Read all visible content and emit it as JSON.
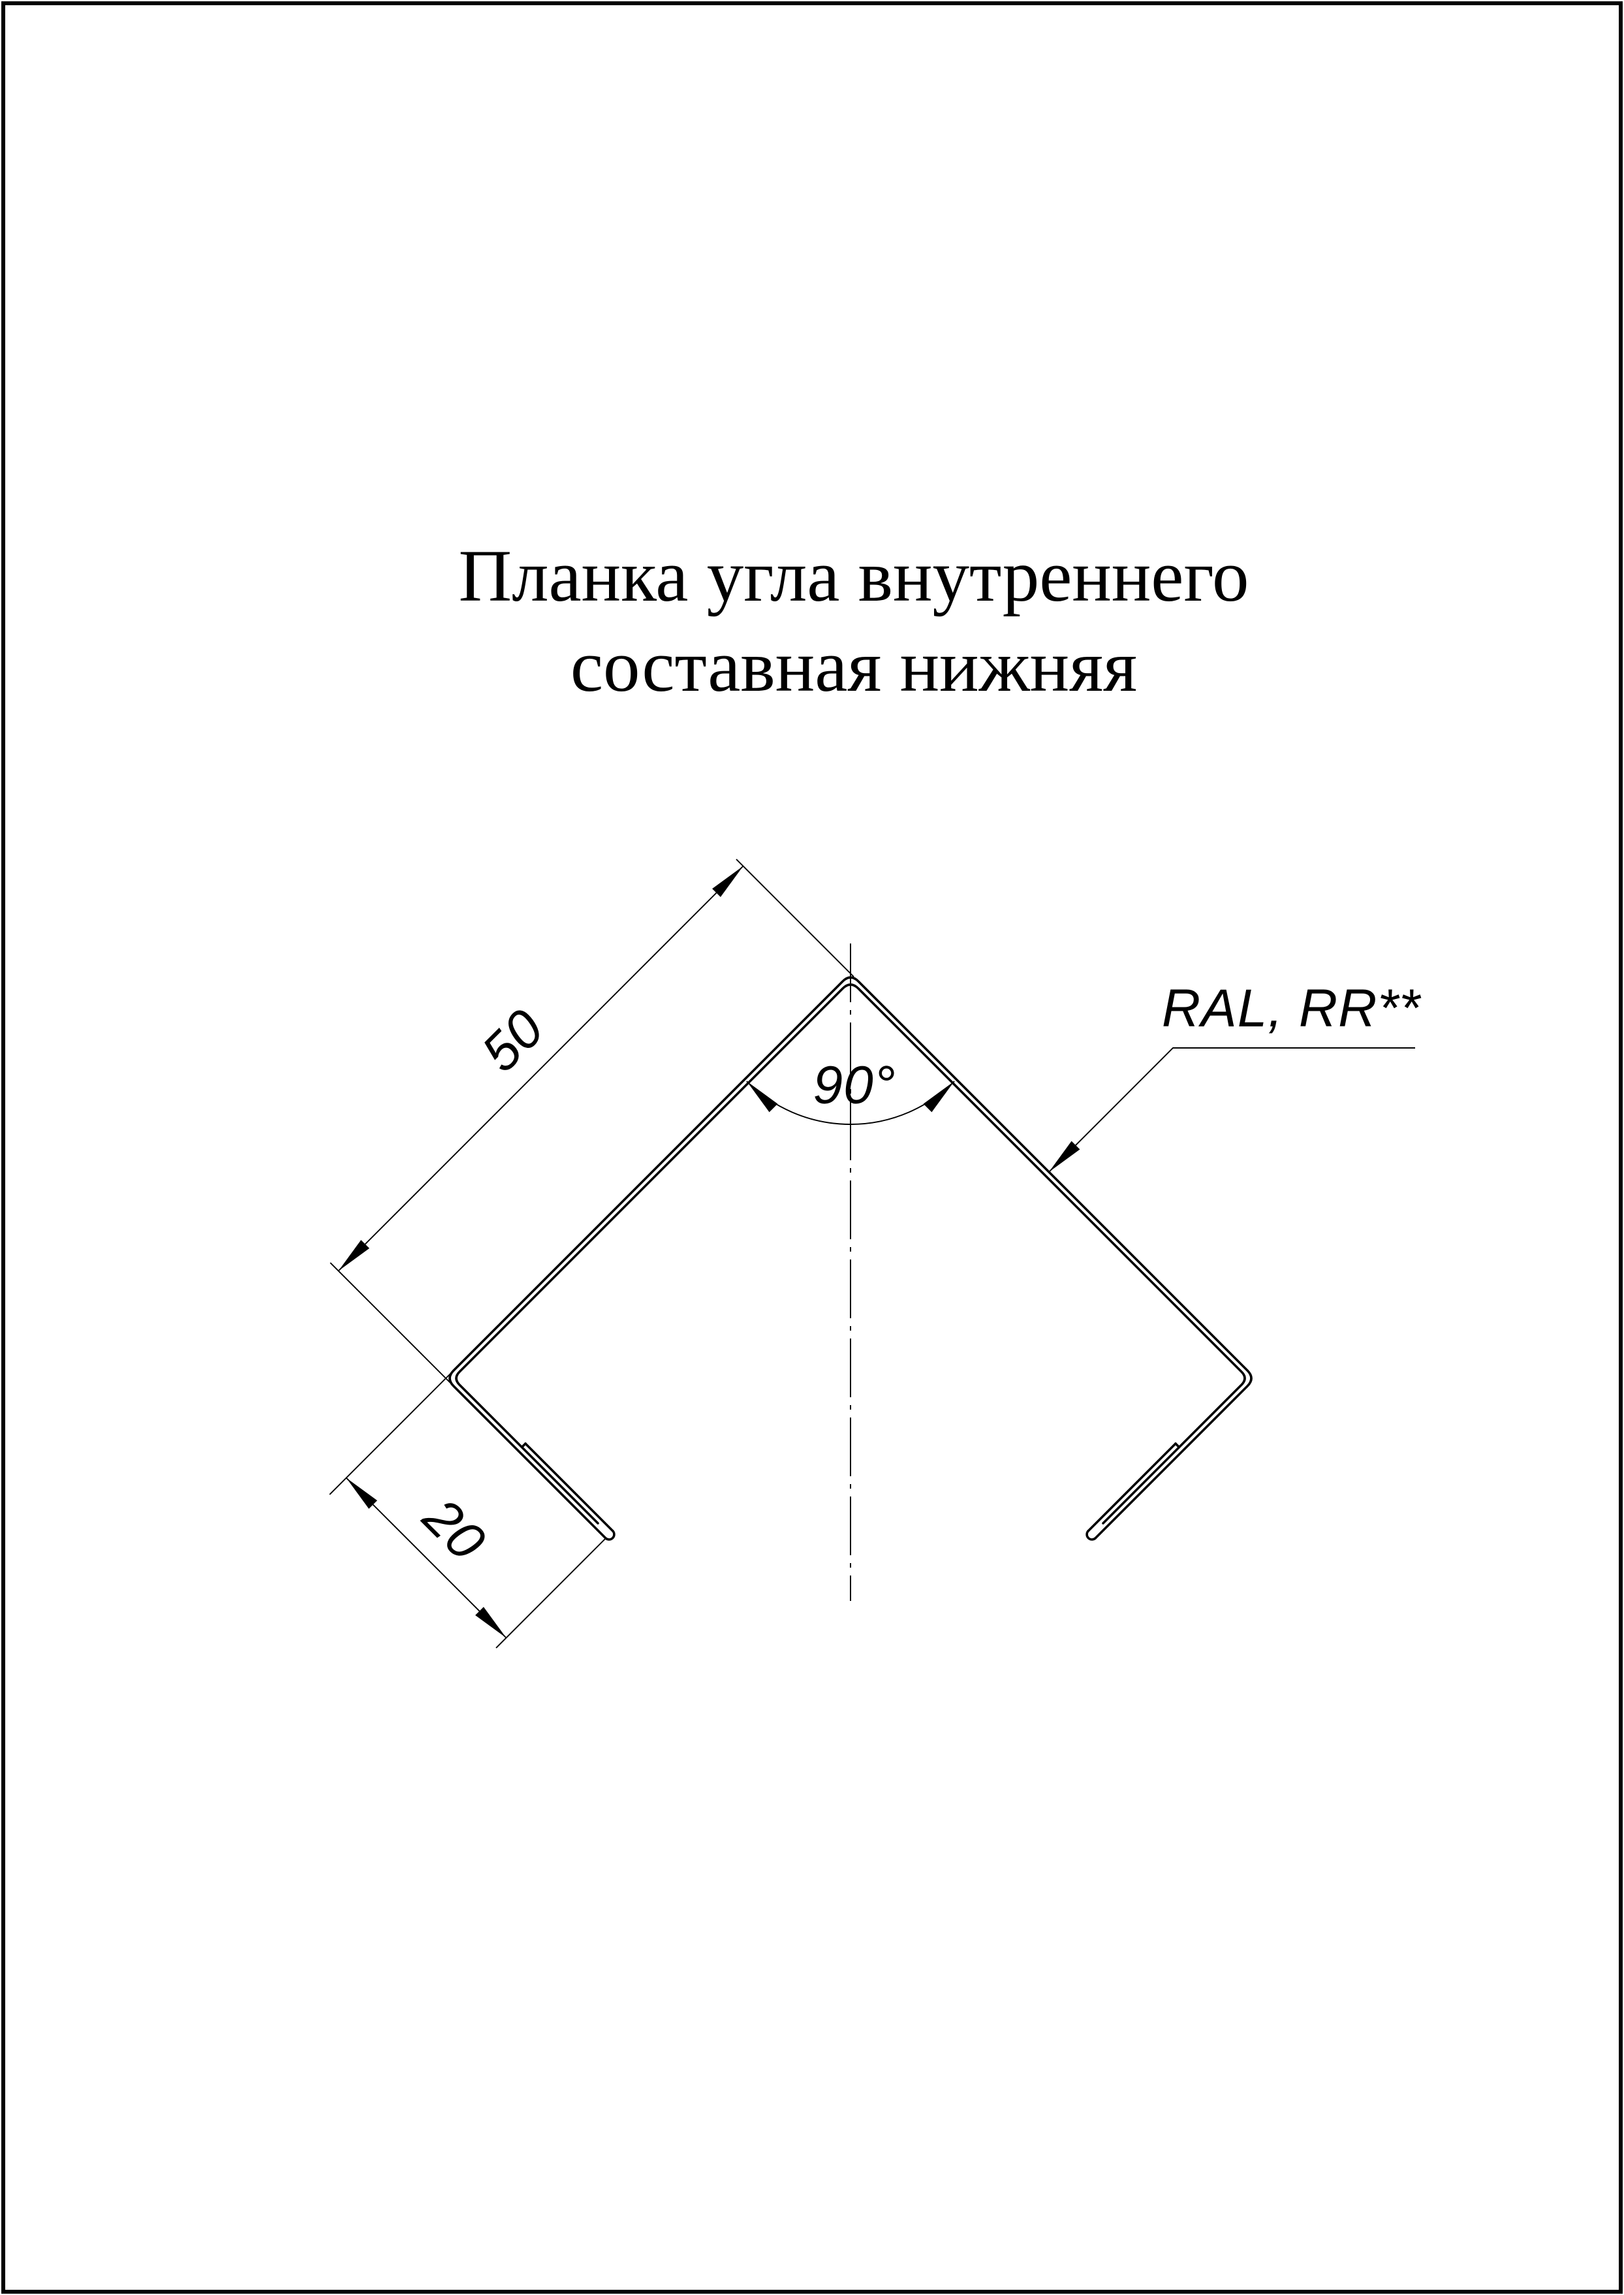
{
  "page": {
    "background": "#ffffff",
    "line_color": "#000000",
    "border_color": "#000000"
  },
  "title": {
    "line1": "Планка угла внутреннего",
    "line2": "составная нижняя"
  },
  "dimensions": {
    "leg_length": "50",
    "flange_length": "20",
    "angle": "90°"
  },
  "leader": {
    "label": "RAL, RR**"
  }
}
